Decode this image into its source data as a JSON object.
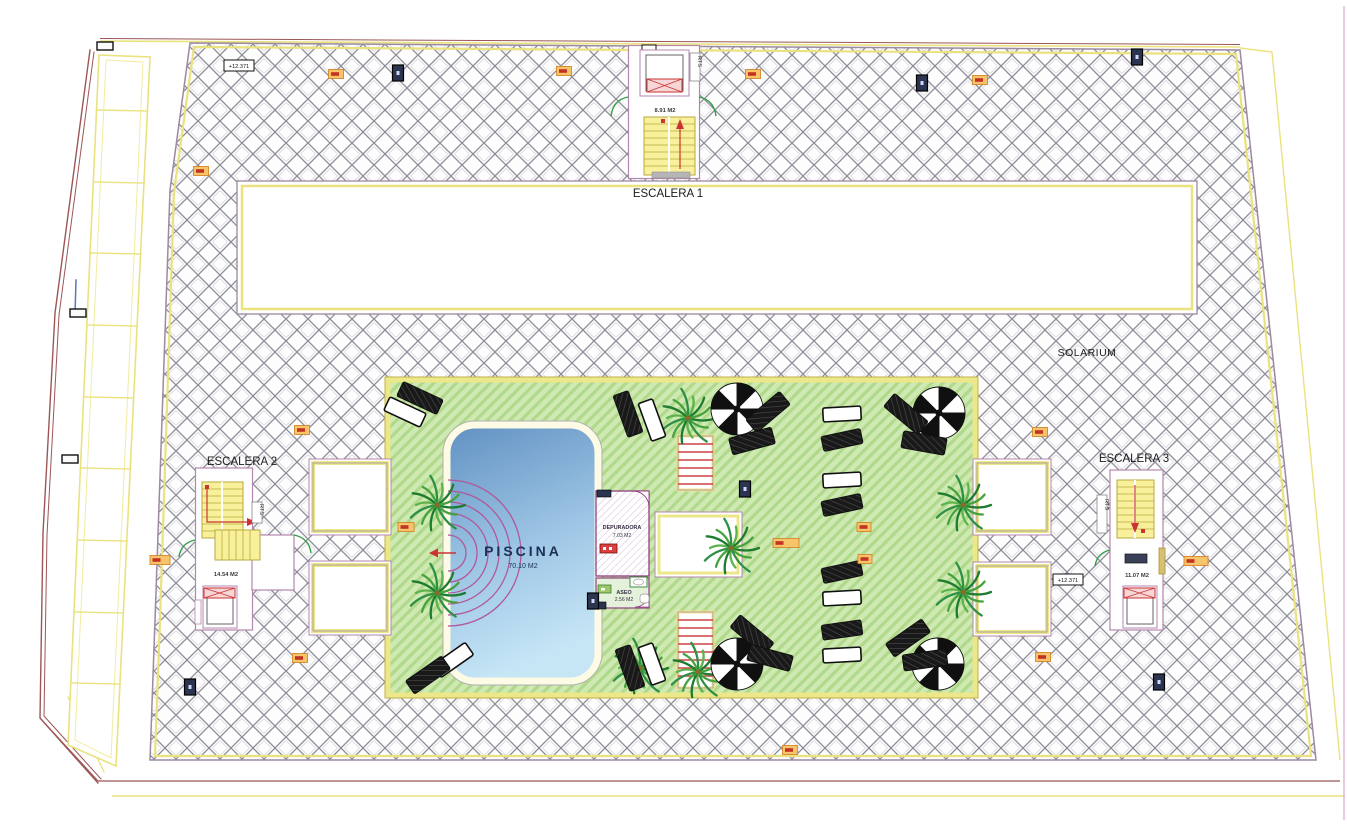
{
  "plan": {
    "solarium": {
      "label": "SOLARIUM"
    },
    "escalera1": {
      "label": "ESCALERA 1",
      "area": "8.91 M2",
      "rts": "RTS"
    },
    "escalera2": {
      "label": "ESCALERA 2",
      "area": "14.54 M2",
      "rts": "RTS"
    },
    "escalera3": {
      "label": "ESCALERA 3",
      "area": "11.07 M2",
      "rts": "RTS",
      "level_badge": "+12.371"
    },
    "pool": {
      "label": "PISCINA",
      "area": "70.10 M2"
    },
    "depuradora": {
      "label": "DEPURADORA",
      "area": "7.03 M2"
    },
    "aseo": {
      "label": "ASEO",
      "area": "2.56 M2"
    },
    "levels": {
      "north_badge": "+12.371"
    }
  },
  "colors": {
    "hatch_line": "#8f8f9a",
    "boundary_purple": "#9b8aa0",
    "boundary_yellow": "#eae27e",
    "boundary_maroon": "#9c5656",
    "wall_pink": "#b487ae",
    "stair_yellow": "#f8f09a",
    "deck_green": "#cfe9b2",
    "deck_stripe": "#b0d98c",
    "pool_blue_dark": "#6191c2",
    "pool_blue_light": "#c6e6f6",
    "door_green": "#2f9e44",
    "accent_red": "#cc3333",
    "marker_orange": "#f6c46a",
    "marker_navy": "#2c3550",
    "palm_green": "#2e8f46"
  }
}
